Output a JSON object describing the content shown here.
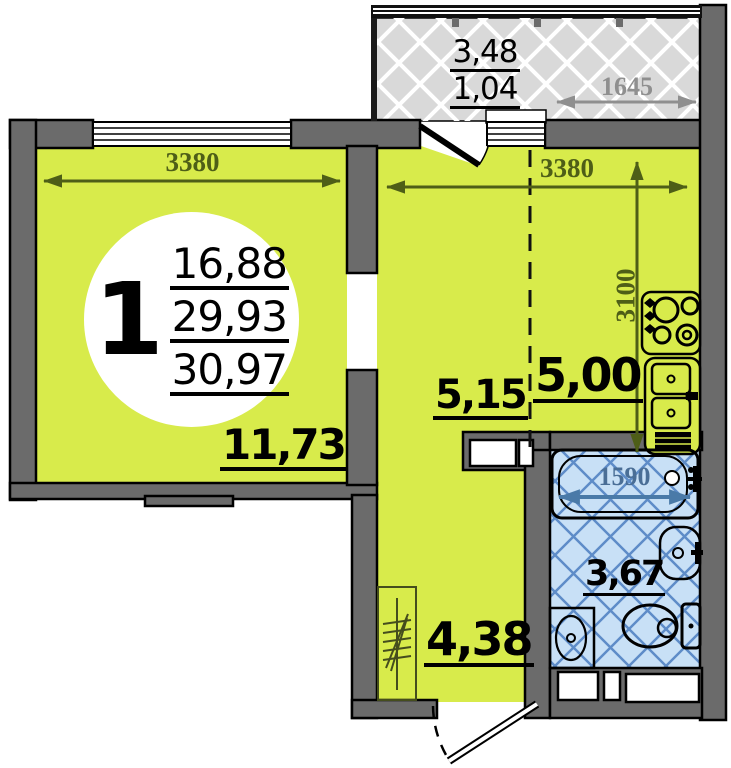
{
  "badge": {
    "room_count": "1",
    "area_living": "16,88",
    "area_total": "29,93",
    "area_with_balcony": "30,97"
  },
  "rooms": {
    "living": {
      "area": "11,73",
      "width_mm": "3380"
    },
    "kitchen": {
      "zone_hall_area": "5,15",
      "zone_kitchen_area": "5,00",
      "width_mm": "3380",
      "depth_mm": "3100"
    },
    "hallway": {
      "area": "4,38"
    },
    "bathroom": {
      "area": "3,67",
      "bathtub_mm": "1590"
    },
    "balcony": {
      "area_full": "3,48",
      "area_reduced": "1,04",
      "width_mm": "1645"
    }
  },
  "fixtures": [
    "stove",
    "kitchen-sink",
    "bathtub",
    "washbasin",
    "toilet",
    "washing-machine",
    "coat-rack"
  ],
  "colors": {
    "room_fill": "#d8eb4b",
    "wall_fill": "#6b6b6b",
    "balcony_floor": "#d9d9d9",
    "bathroom_floor": "#c8e0f6",
    "bathroom_grid": "#5e8cc8",
    "dim_olive": "#4e5e17",
    "dim_gray": "#8f8f8f",
    "dim_blue": "#4a6e96"
  }
}
